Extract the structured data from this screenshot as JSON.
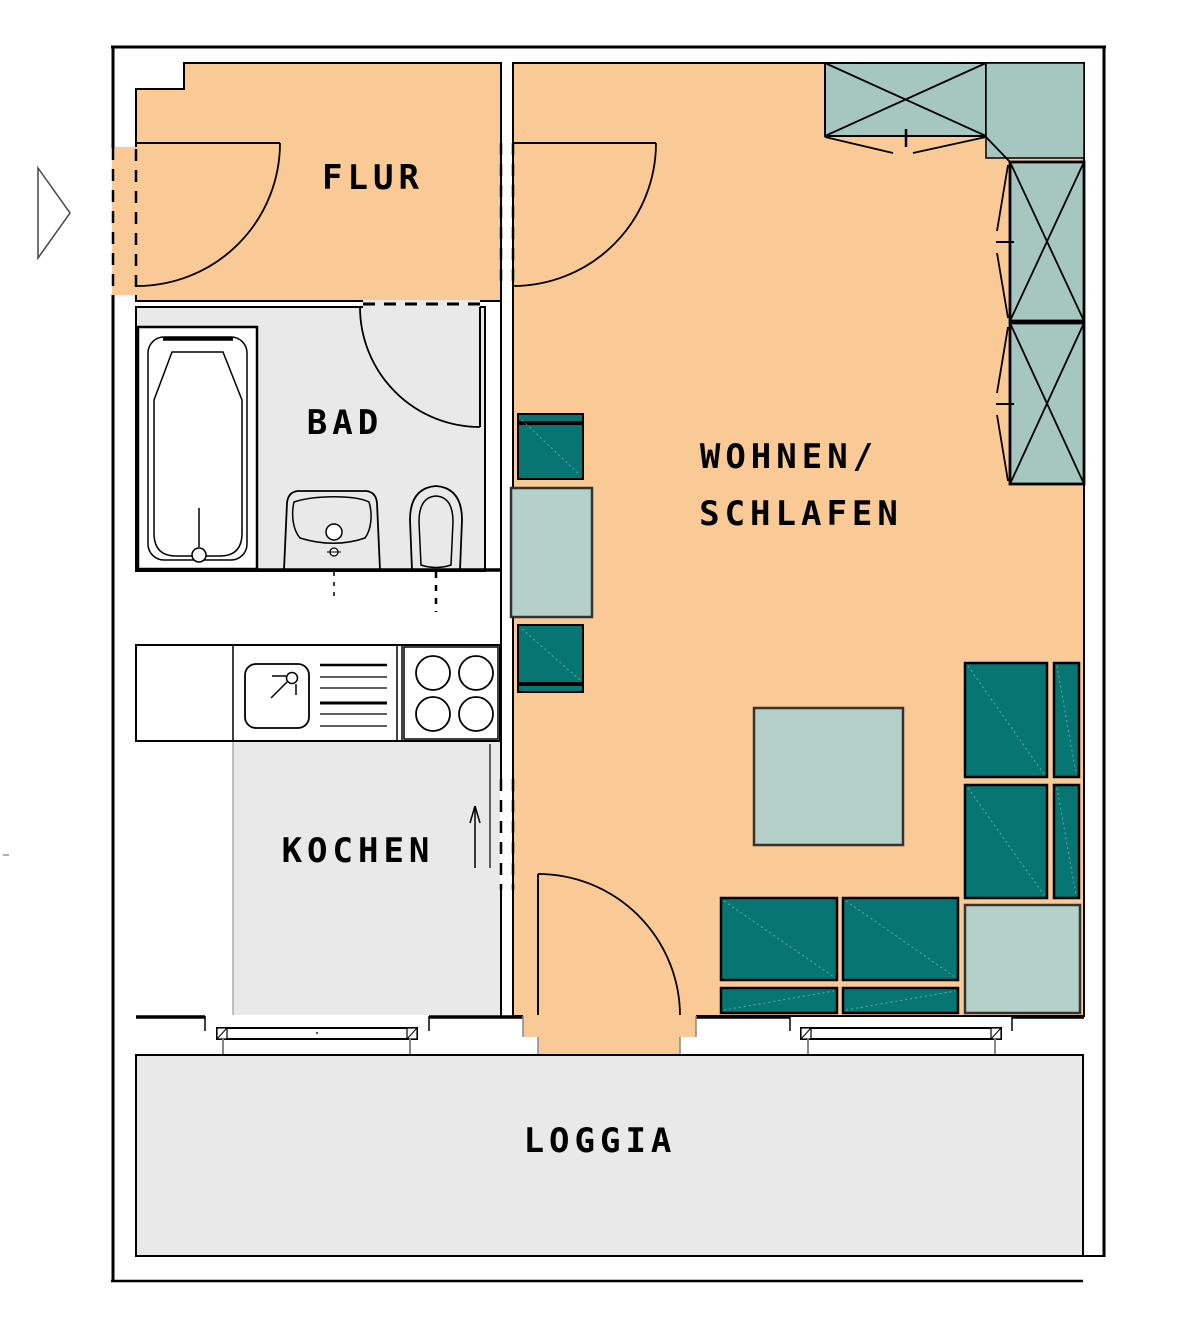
{
  "title": "Apartment floor plan",
  "rooms": {
    "flur": {
      "label": "FLUR"
    },
    "bad": {
      "label": "BAD"
    },
    "kochen": {
      "label": "KOCHEN"
    },
    "wohnen_schlafen": {
      "label_line1": "WOHNEN/",
      "label_line2": "SCHLAFEN"
    },
    "loggia": {
      "label": "LOGGIA"
    }
  },
  "colors": {
    "floor_orange": "#F9CA95",
    "floor_gray": "#E9E9E9",
    "furniture_teal": "#077672",
    "table_teal": "#B5CFC9",
    "wardrobe_teal": "#A6C6C0",
    "outline": "#000000",
    "wall_gray_line": "#888888"
  }
}
